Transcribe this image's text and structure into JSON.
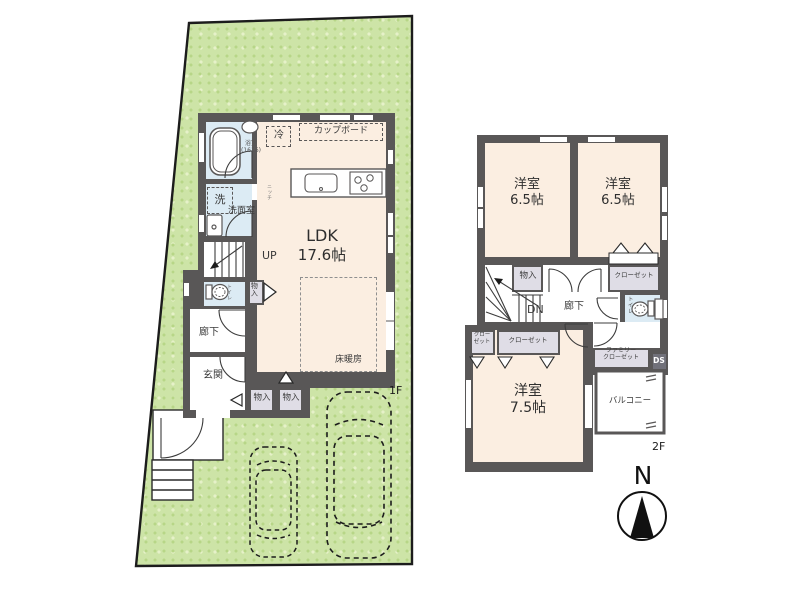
{
  "colors": {
    "wall": "#595757",
    "room_floor": "#fbeee1",
    "wet_floor": "#dcebf4",
    "closet_fill": "#dfdde6",
    "site_green": "#cde4a7",
    "outline": "#1c1c1c"
  },
  "floor1": {
    "label": "1F",
    "ldk": {
      "name": "LDK",
      "size": "17.6帖"
    },
    "floor_heating": "床暖房",
    "kitchen": {
      "fridge": "冷",
      "cupboard": "カップボード"
    },
    "bath": {
      "name": "浴室",
      "size": "(1616)"
    },
    "washroom": "洗面室",
    "washer": "洗",
    "niche": "ニッチ",
    "stairs_up": "UP",
    "toilet": "トイレ",
    "storage_side": "物入",
    "hall": "廊下",
    "entrance": "玄関",
    "storage_a": "物入",
    "storage_b": "物入"
  },
  "floor2": {
    "label": "2F",
    "room_a": {
      "name": "洋室",
      "size": "6.5帖"
    },
    "room_b": {
      "name": "洋室",
      "size": "6.5帖"
    },
    "room_c": {
      "name": "洋室",
      "size": "7.5帖"
    },
    "storage": "物入",
    "stairs_down": "DN",
    "hall": "廊下",
    "toilet": "トイレ",
    "closet_right": "クローゼット",
    "closet_small": {
      "line1": "クロー",
      "line2": "ゼット"
    },
    "closet_wide": "クローゼット",
    "family_closet": {
      "line1": "ファミリー",
      "line2": "クローゼット"
    },
    "duct_space": "DS",
    "balcony": "バルコニー"
  },
  "compass": {
    "north": "N"
  }
}
